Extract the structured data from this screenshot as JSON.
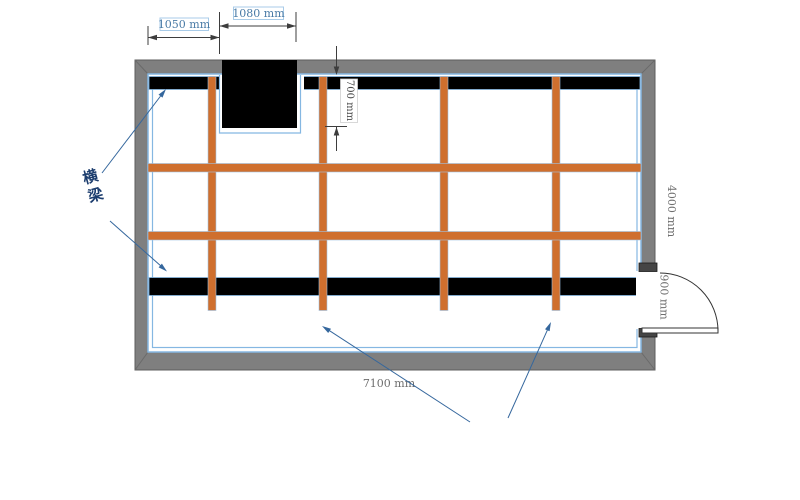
{
  "plan": {
    "dims": {
      "top_left": "1050 mm",
      "top_opening": "1080 mm",
      "opening_depth": "700 mm",
      "height": "4000 mm",
      "door": "900 mm",
      "width": "7100 mm"
    },
    "labels": {
      "crossbeam": "横梁",
      "frame_line1": "防锈槽钢",
      "frame_line2": "散力架"
    },
    "colors": {
      "wall_gray": "#7f7f7f",
      "beam_black": "#000000",
      "steel_orange": "#cf6f2e",
      "lining_blue": "#85b7e2",
      "leader_blue": "#35679d",
      "dim_blue_text": "#4a7ba6",
      "dim_gray_text": "#6e6e6e",
      "cn_navy_text": "#1c3d6e"
    }
  }
}
